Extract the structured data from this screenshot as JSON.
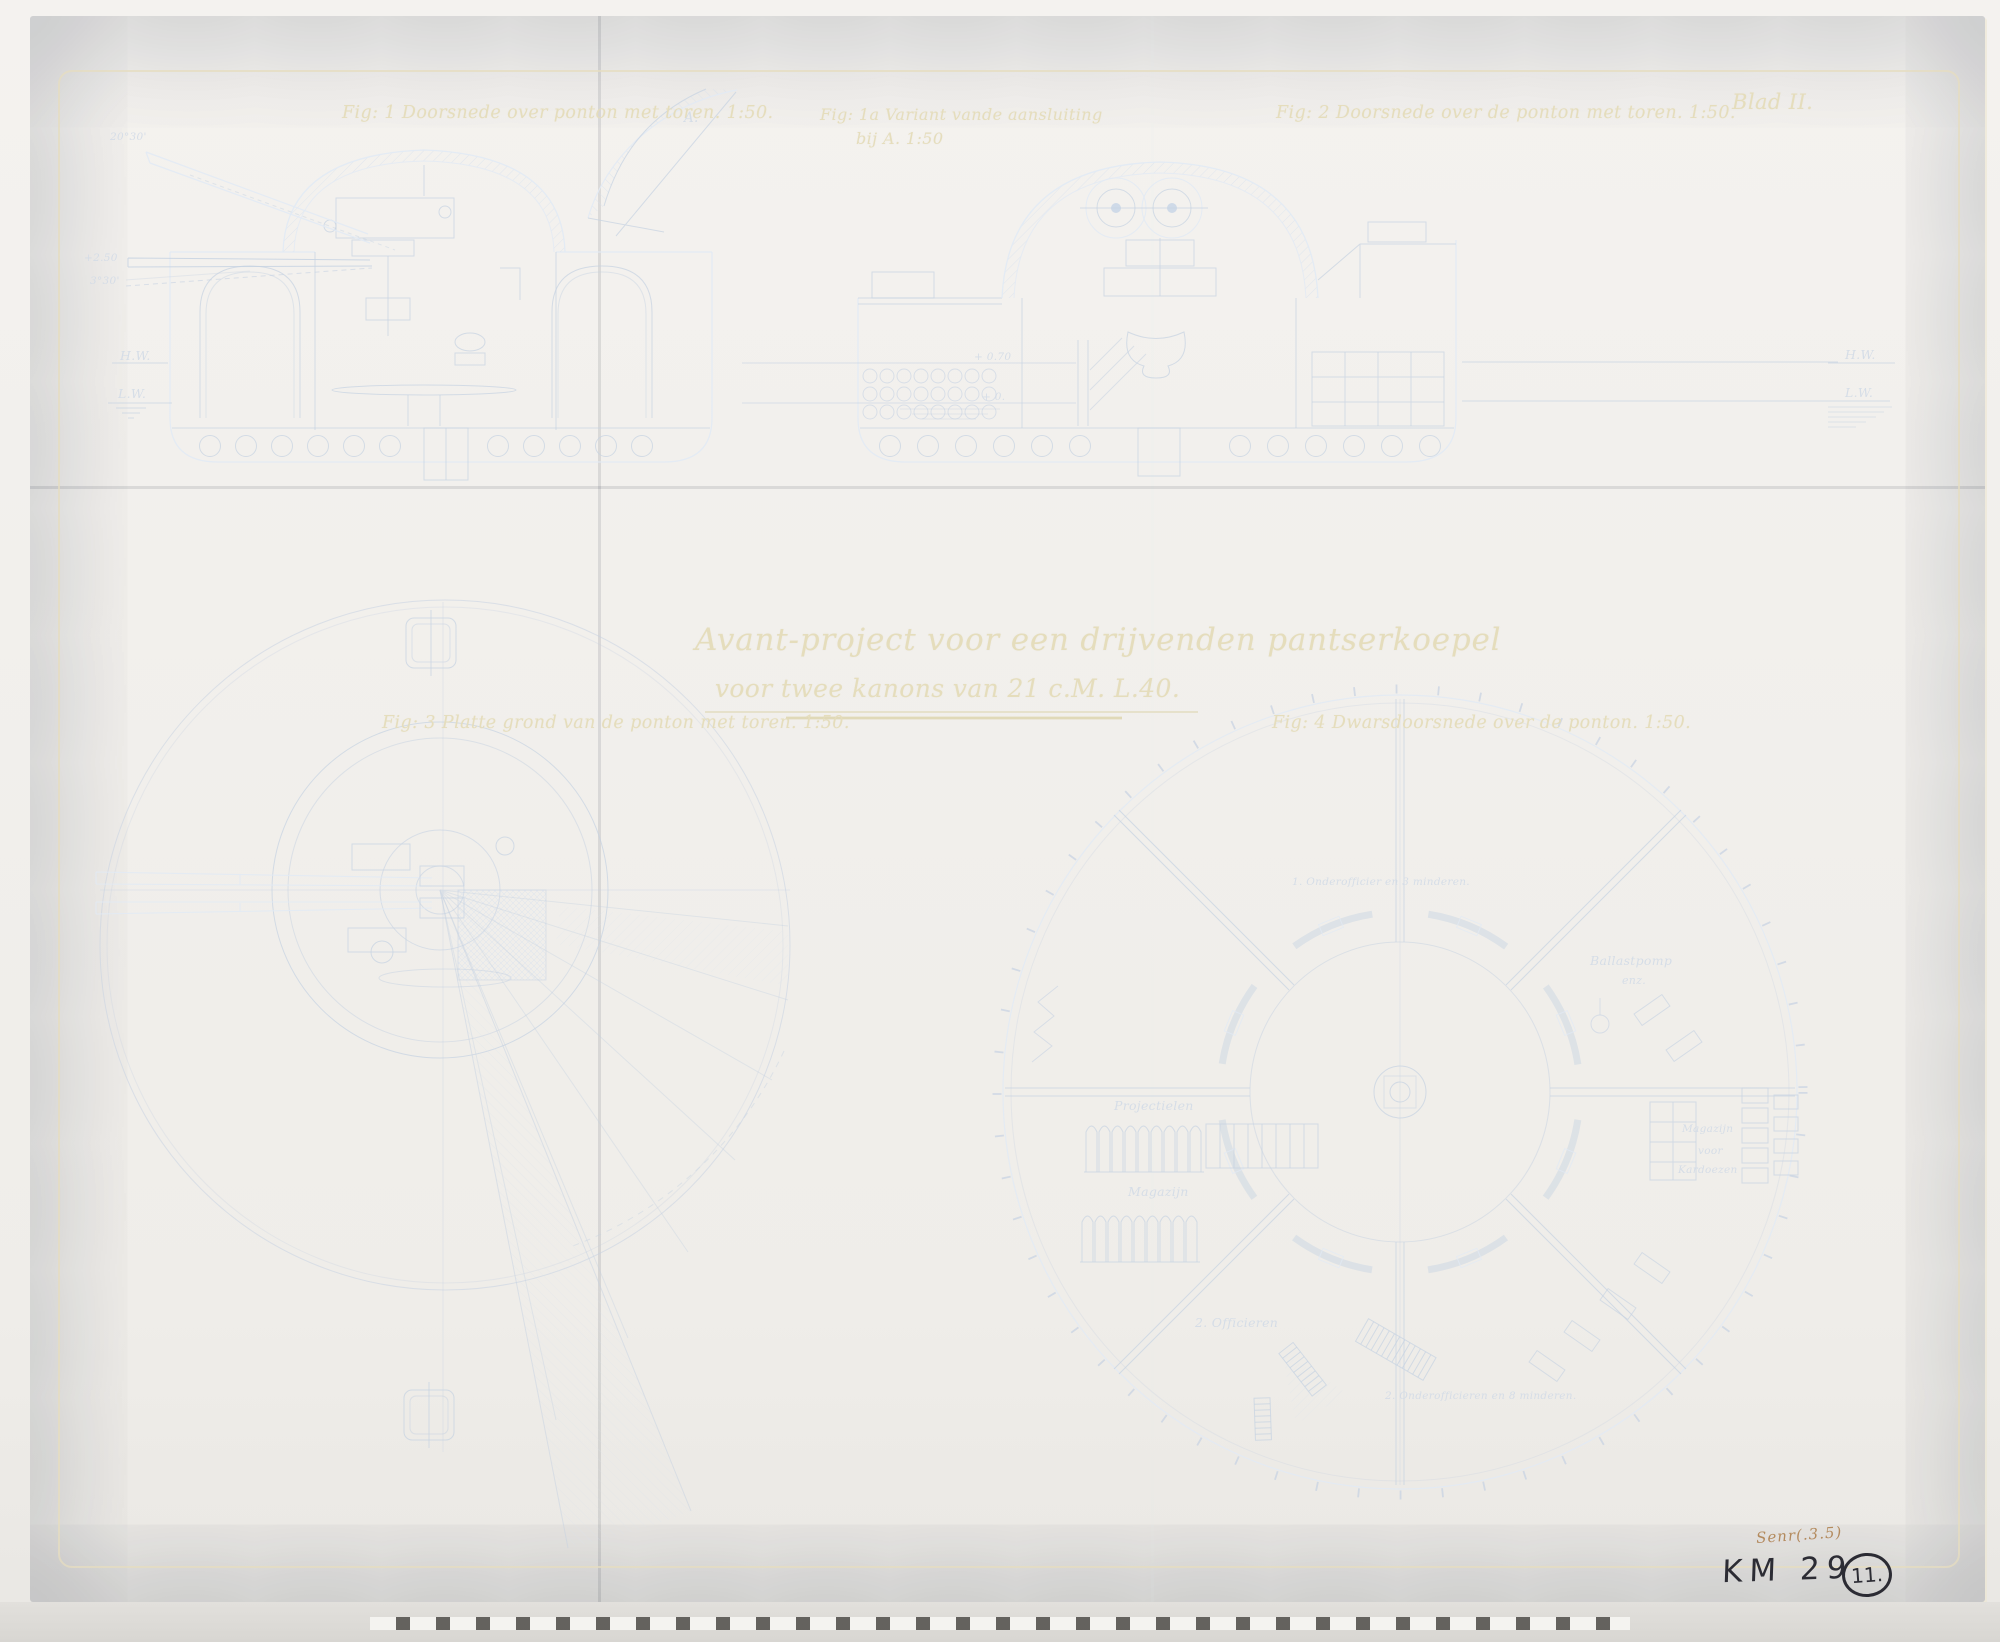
{
  "sheet": {
    "blad": "Blad II.",
    "title1": "Avant-project voor een drijvenden pantserkoepel",
    "title2": "voor twee kanons van 21 c.M. L.40."
  },
  "fig1": {
    "caption": "Fig: 1 Doorsnede over ponton met toren.  1:50.",
    "angle_max": "20°30'",
    "height": "+2.50",
    "angle_min": "3°30'",
    "hw": "H.W.",
    "lw": "L.W.",
    "point_a": "A."
  },
  "fig1a": {
    "caption1": "Fig: 1a  Variant vande aansluiting",
    "caption2": "bij A.  1:50"
  },
  "fig2": {
    "caption": "Fig: 2 Doorsnede over de ponton met toren. 1:50.",
    "wl_070": "+ 0.70",
    "wl_0": "+ 0.",
    "hw": "H.W.",
    "lw": "L.W."
  },
  "fig3": {
    "caption": "Fig: 3 Platte grond van de ponton met toren.  1:50."
  },
  "fig4": {
    "caption": "Fig: 4 Dwarsdoorsnede over de ponton.  1:50.",
    "labels": {
      "crew_top": "1. Onderofficier en 3 minderen.",
      "ballast1": "Ballastpomp",
      "ballast2": "enz.",
      "projectielen": "Projectielen",
      "magazijn": "Magazijn",
      "kardoezen1": "Magazijn",
      "kardoezen2": "voor",
      "kardoezen3": "Kardoezen",
      "officieren": "2. Officieren",
      "crew_bottom": "2. Onderofficieren en 8 minderen."
    }
  },
  "annotations": {
    "sepia": "Senr(.3.5)",
    "km": "KM 29",
    "circled": "11."
  }
}
